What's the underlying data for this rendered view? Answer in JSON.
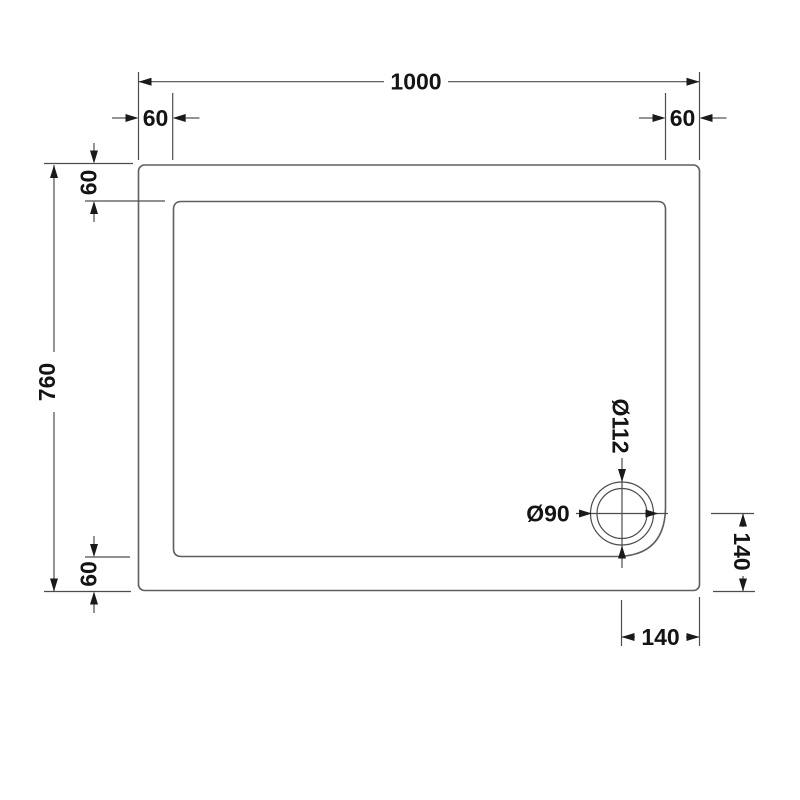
{
  "drawing": {
    "subject": "rectangular shower tray plan view technical drawing",
    "background_color": "#ffffff",
    "line_color": "#5f5f5f",
    "dimension_line_color": "#4d4d4d",
    "text_color": "#141414",
    "dims": {
      "overall_width": "1000",
      "overall_depth": "760",
      "wall_top_left": "60",
      "wall_top_right": "60",
      "wall_left_top": "60",
      "wall_left_bottom": "60",
      "waste_outer_diameter": "Ø112",
      "waste_inner_diameter": "Ø90",
      "waste_offset_right": "140",
      "waste_offset_bottom": "140"
    }
  }
}
